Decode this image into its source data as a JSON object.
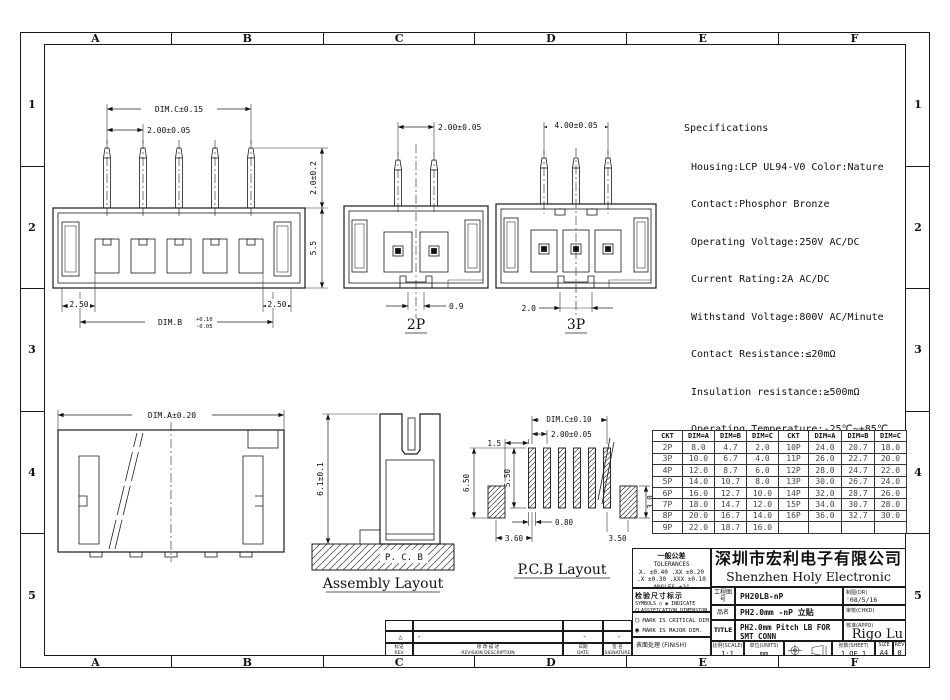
{
  "frame": {
    "cols": [
      "A",
      "B",
      "C",
      "D",
      "E",
      "F"
    ],
    "rows": [
      "1",
      "2",
      "3",
      "4",
      "5"
    ]
  },
  "specs": {
    "title": "Specifications",
    "lines": [
      "Housing:LCP UL94-V0 Color:Nature",
      "Contact:Phosphor Bronze",
      "Operating Voltage:250V AC/DC",
      "Current Rating:2A AC/DC",
      "Withstand Voltage:800V AC/Minute",
      "Contact Resistance:≤20mΩ",
      "Insulation resistance:≥500mΩ",
      "Operating Temperature:-25℃~+85℃"
    ]
  },
  "front5p": {
    "dim_c": "DIM.C±0.15",
    "pitch": "2.00±0.05",
    "pin_height": "2.0±0.2",
    "body_height": "5.5",
    "left_margin": "2.50",
    "right_margin": "2.50",
    "dim_b": "DIM.B",
    "dim_b_upper": "+0.10",
    "dim_b_lower": "-0.05"
  },
  "front2p": {
    "pitch": "2.00±0.05",
    "slot": "0.9",
    "label": "2P"
  },
  "front3p": {
    "pitch": "4.00±0.05",
    "slot": "2.0",
    "label": "3P"
  },
  "assembly": {
    "dim_a": "DIM.A±0.20",
    "height": "6.1±0.1",
    "pcb": "P. C. B",
    "label": "Assembly Layout"
  },
  "pcb_layout": {
    "dim_c": "DIM.C±0.10",
    "pitch": "2.00±0.05",
    "edge": "1.5",
    "total_h": "6.50",
    "pad_h": "5.50",
    "pad_w": "0.80",
    "left_gap": "3.60",
    "right_gap": "3.50",
    "nail_h": "3.0",
    "label": "P.C.B Layout"
  },
  "table": {
    "headers": [
      "CKT",
      "DIM=A",
      "DIM=B",
      "DIM=C",
      "CKT",
      "DIM=A",
      "DIM=B",
      "DIM=C"
    ],
    "rows": [
      [
        "2P",
        "8.0",
        "4.7",
        "2.0",
        "10P",
        "24.0",
        "20.7",
        "18.0"
      ],
      [
        "3P",
        "10.0",
        "6.7",
        "4.0",
        "11P",
        "26.0",
        "22.7",
        "20.0"
      ],
      [
        "4P",
        "12.0",
        "8.7",
        "6.0",
        "12P",
        "28.0",
        "24.7",
        "22.0"
      ],
      [
        "5P",
        "14.0",
        "10.7",
        "8.0",
        "13P",
        "30.0",
        "26.7",
        "24.0"
      ],
      [
        "6P",
        "16.0",
        "12.7",
        "10.0",
        "14P",
        "32.0",
        "28.7",
        "26.0"
      ],
      [
        "7P",
        "18.0",
        "14.7",
        "12.0",
        "15P",
        "34.0",
        "30.7",
        "28.0"
      ],
      [
        "8P",
        "20.0",
        "16.7",
        "14.0",
        "16P",
        "36.0",
        "32.7",
        "30.0"
      ],
      [
        "9P",
        "22.0",
        "18.7",
        "16.0",
        "",
        "",
        "",
        ""
      ]
    ]
  },
  "titleblock": {
    "tol_title_cn": "一般公差",
    "tol_title": "TOLERANCES",
    "tol_line1": "X. ±0.40   .XX ±0.20",
    "tol_line2": ".X ±0.30  .XXX ±0.10",
    "tol_line3": "ANGLES    ±2°",
    "company_cn": "深圳市宏利电子有限公司",
    "company_en": "Shenzhen Holy Electronic Co.,Ltd",
    "insp_cn": "检验尺寸标示",
    "insp_en1": "SYMBOLS ◯ ◉ INDICATE",
    "insp_en2": "CLASSIFICATION DIMENSION",
    "mark1_icon": "◯",
    "mark1": "MARK IS CRITICAL DIM",
    "mark2_icon": "◉",
    "mark2": "MARK IS MAJOR DIM.",
    "finish": "表面处理 (FINISH)",
    "r1_label": "工程图号",
    "r1_value": "PH20LB-nP",
    "dr_label": "制图(DR)",
    "dr_value": "'08/5/16",
    "r2_label": "品名",
    "r2_value": "PH2.0mm -nP 立贴",
    "chk_label": "审核(CHKD)",
    "r3_label": "TITLE",
    "r3_value1": "PH2.0mm Pitch LB FOR",
    "r3_value2": "SMT CONN",
    "appd_label": "核准(APPD)",
    "appd_value": "Rigo Lu",
    "scale_label": "比例(SCALE)",
    "scale_value": "1:1",
    "units_label": "单位(UNITS)",
    "units_value": "mm",
    "sheet_label": "张数(SHEET)",
    "sheet_value": "1 OF 1",
    "size_label": "SIZE",
    "size_value": "A4",
    "rev_label": "REV",
    "rev_value": "0"
  },
  "revision": {
    "mark": "△",
    "dash1": "-",
    "dash2": "-",
    "dash3": "-",
    "h_rev_cn": "标记",
    "h_rev": "REV",
    "h_desc_cn": "修 改 描 述",
    "h_desc": "REVISION DESCRIPTION",
    "h_date_cn": "日期",
    "h_date": "DATE",
    "h_sig_cn": "签 名",
    "h_sig": "SIGNATURE"
  }
}
